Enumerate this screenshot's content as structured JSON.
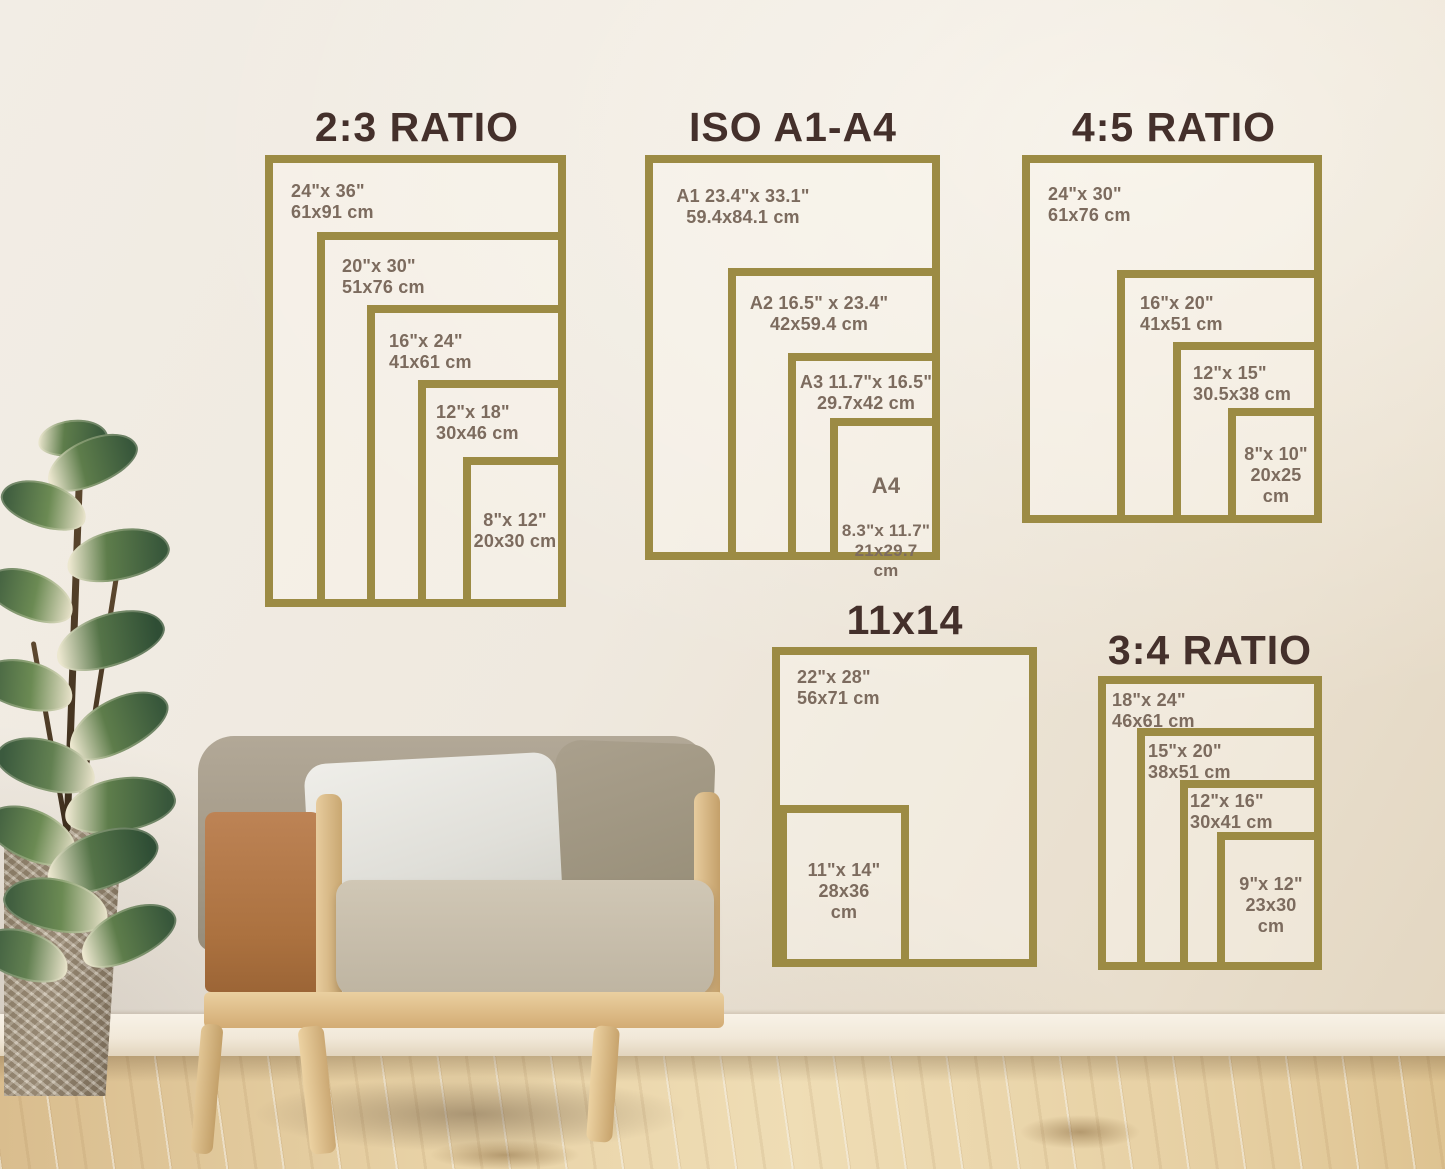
{
  "colors": {
    "frame_gold": "#9c8b44",
    "title_brown": "#44302b",
    "label_brown": "#7c6b5e"
  },
  "charts": {
    "ratio23": {
      "title": "2:3 RATIO",
      "labels": {
        "s2436": "24\"x 36\"\n61x91 cm",
        "s2030": "20\"x 30\"\n51x76 cm",
        "s1624": "16\"x 24\"\n41x61 cm",
        "s1218": "12\"x 18\"\n30x46 cm",
        "s812": "8\"x 12\"\n20x30 cm"
      }
    },
    "isoA1A4": {
      "title": "ISO A1-A4",
      "labels": {
        "a1": "A1 23.4\"x 33.1\"\n59.4x84.1 cm",
        "a2": "A2 16.5\" x 23.4\"\n42x59.4 cm",
        "a3": "A3 11.7\"x 16.5\"\n29.7x42 cm",
        "a4_name": "A4",
        "a4_dims": "8.3\"x 11.7\"\n21x29.7\ncm"
      }
    },
    "ratio45": {
      "title": "4:5 RATIO",
      "labels": {
        "s2430": "24\"x 30\"\n61x76 cm",
        "s1620": "16\"x 20\"\n41x51 cm",
        "s1215": "12\"x 15\"\n30.5x38 cm",
        "s810": "8\"x 10\"\n20x25\ncm"
      }
    },
    "size11x14": {
      "title": "11x14",
      "labels": {
        "s2228": "22\"x 28\"\n56x71 cm",
        "s1114": "11\"x 14\"\n28x36\ncm"
      }
    },
    "ratio34": {
      "title": "3:4 RATIO",
      "labels": {
        "s1824": "18\"x 24\"\n46x61 cm",
        "s1520": "15\"x 20\"\n38x51 cm",
        "s1216": "12\"x 16\"\n30x41 cm",
        "s912": "9\"x 12\"\n23x30\ncm"
      }
    }
  }
}
